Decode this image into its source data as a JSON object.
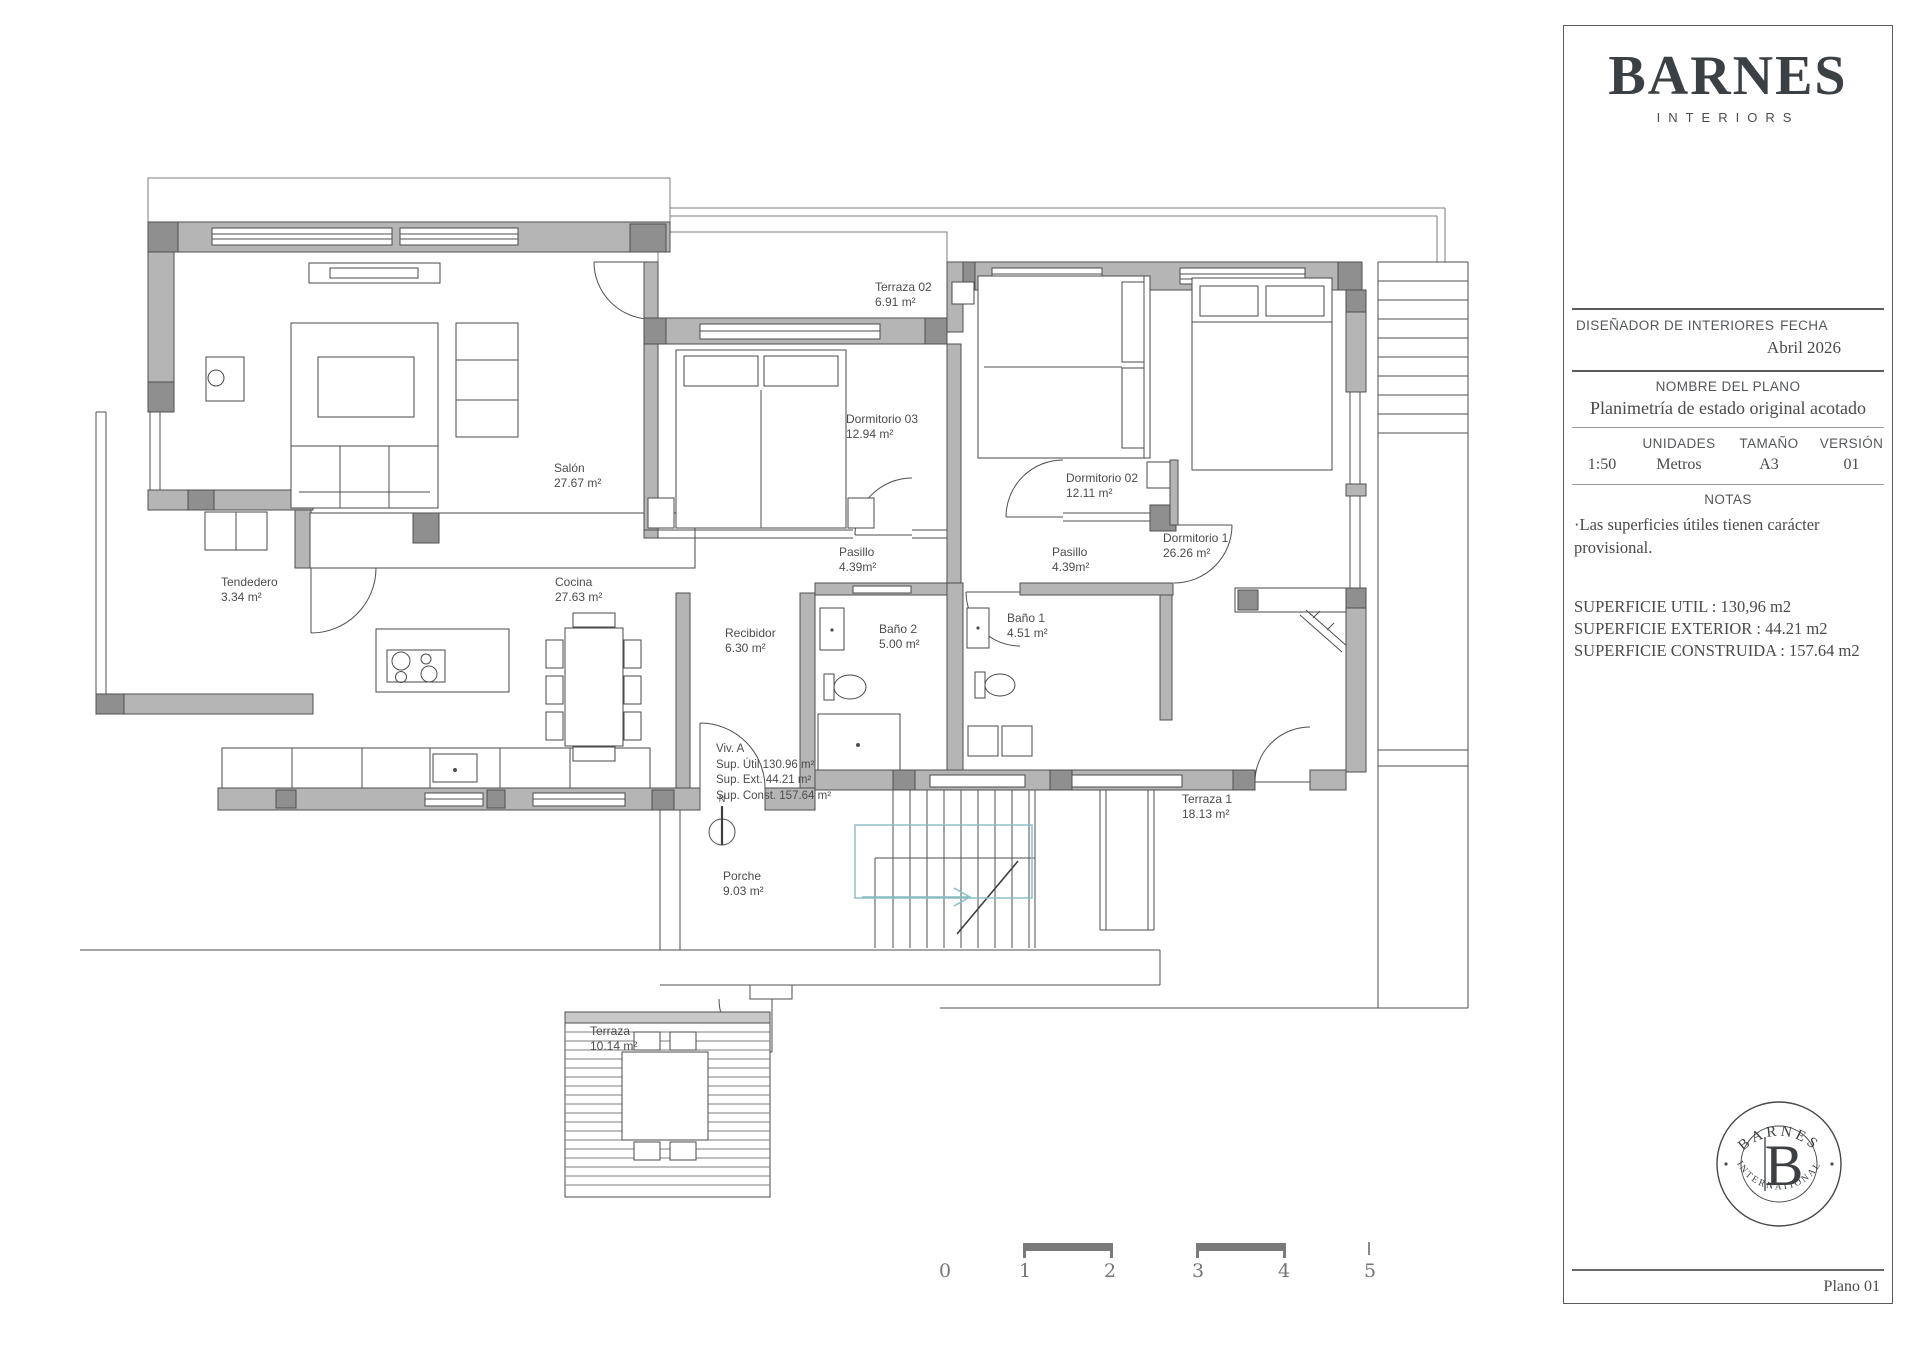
{
  "title_block": {
    "brand": "BARNES",
    "brand_sub": "INTERIORS",
    "designer_label": "DISEÑADOR DE INTERIORES",
    "date_label": "FECHA",
    "date_value": "Abril 2026",
    "plan_name_label": "NOMBRE DEL PLANO",
    "plan_name_value": "Planimetría de estado original acotado",
    "scale_value": "1:50",
    "units_label": "UNIDADES",
    "units_value": "Metros",
    "size_label": "TAMAÑO",
    "size_value": "A3",
    "version_label": "VERSIÓN",
    "version_value": "01",
    "notes_label": "NOTAS",
    "notes_line1": "·Las superficies útiles tienen carácter",
    "notes_line2": "provisional.",
    "superficie_util": "SUPERFICIE UTIL : 130,96 m2",
    "superficie_exterior": "SUPERFICIE EXTERIOR : 44.21 m2",
    "superficie_construida": "SUPERFICIE CONSTRUIDA : 157.64 m2",
    "stamp_top": "BARNES",
    "stamp_bottom": "INTERNATIONAL",
    "stamp_letter": "B",
    "page_label": "Plano 01"
  },
  "plan": {
    "rooms": [
      {
        "name": "Terraza 02",
        "area": "6.91 m²"
      },
      {
        "name": "Dormitorio 03",
        "area": "12.94 m²"
      },
      {
        "name": "Salón",
        "area": "27.67 m²"
      },
      {
        "name": "Dormitorio 02",
        "area": "12.11 m²"
      },
      {
        "name": "Dormitorio 1",
        "area": "26.26 m²"
      },
      {
        "name": "Tendedero",
        "area": "3.34 m²"
      },
      {
        "name": "Cocina",
        "area": "27.63 m²"
      },
      {
        "name": "Pasillo",
        "area": "4.39m²"
      },
      {
        "name": "Pasillo",
        "area": "4.39m²"
      },
      {
        "name": "Recibidor",
        "area": "6.30 m²"
      },
      {
        "name": "Baño 2",
        "area": "5.00 m²"
      },
      {
        "name": "Baño 1",
        "area": "4.51 m²"
      },
      {
        "name": "Terraza 1",
        "area": "18.13 m²"
      },
      {
        "name": "Porche",
        "area": "9.03 m²"
      },
      {
        "name": "Terraza",
        "area": "10.14 m²"
      }
    ],
    "unit_summary": {
      "title": "Viv. A",
      "line1": "Sup. Útil 130.96 m²",
      "line2": "Sup. Ext. 44.21 m²",
      "line3": "Sup. Const. 157.64 m²"
    },
    "north_label": "N",
    "scale_bar_numbers": [
      "0",
      "1",
      "2",
      "3",
      "4",
      "5"
    ]
  }
}
